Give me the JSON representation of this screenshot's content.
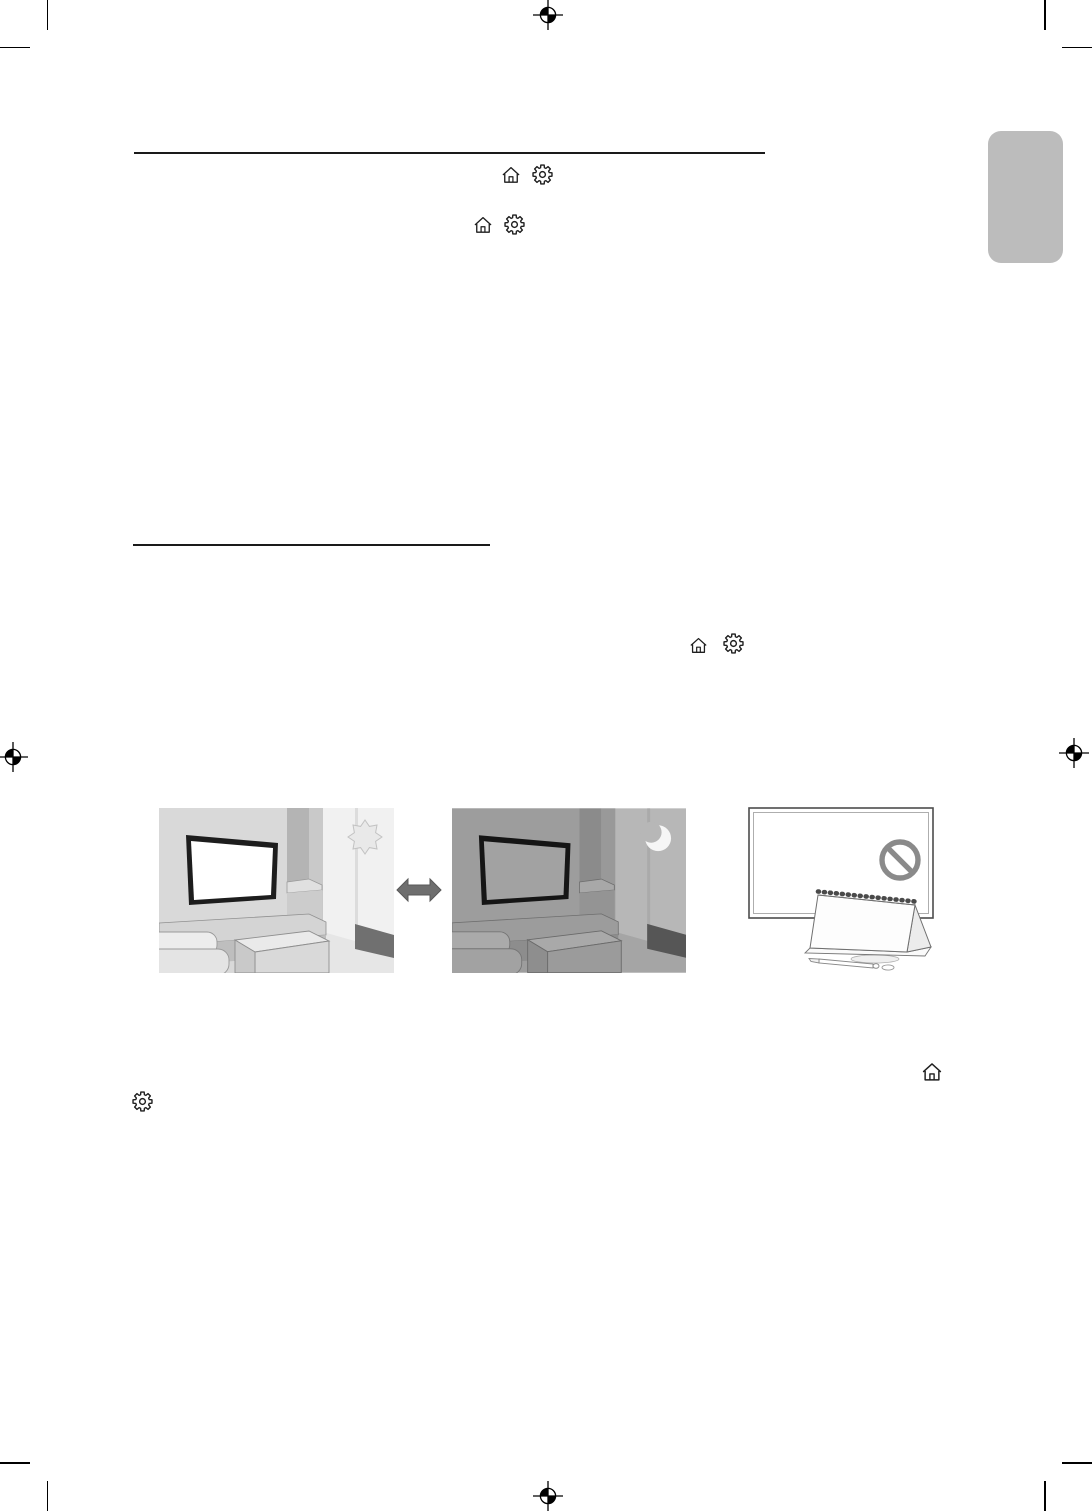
{
  "document": {
    "kind": "printed-manual-page",
    "visible_text": "",
    "note_colors": {
      "page_background": "#ffffff",
      "rule_color": "#1a1a1a",
      "icon_stroke": "#1f1f1f",
      "side_tab": "#bcbcbc",
      "swap_arrow": "#6e6e6e",
      "prohibition_sign": "#8a8a8a"
    }
  },
  "printer_marks": {
    "registration_targets": [
      {
        "id": "registration-top-center"
      },
      {
        "id": "registration-left-middle"
      },
      {
        "id": "registration-right-middle"
      },
      {
        "id": "registration-bottom-center"
      }
    ],
    "crop_corners": [
      "top-left",
      "top-right",
      "bottom-left",
      "bottom-right"
    ]
  },
  "rules": [
    {
      "id": "section-rule-top"
    },
    {
      "id": "section-rule-middle"
    }
  ],
  "icons": {
    "home": "home-icon",
    "settings": "settings-gear-icon"
  },
  "inline_icon_groups": [
    {
      "id": "icon-row-1",
      "icons": [
        "home-icon",
        "settings-gear-icon"
      ]
    },
    {
      "id": "icon-row-2",
      "icons": [
        "home-icon",
        "settings-gear-icon"
      ]
    },
    {
      "id": "icon-row-3",
      "icons": [
        "home-icon",
        "settings-gear-icon"
      ]
    },
    {
      "id": "icon-home-bottom-right",
      "icons": [
        "home-icon"
      ]
    },
    {
      "id": "icon-settings-bottom-left",
      "icons": [
        "settings-gear-icon"
      ]
    }
  ],
  "figures": [
    {
      "id": "figure-day-scene",
      "alt": "living-room-daytime-with-tv-and-sun"
    },
    {
      "id": "figure-swap-arrow",
      "alt": "double-headed-swap-arrow"
    },
    {
      "id": "figure-night-scene",
      "alt": "living-room-nighttime-with-tv-and-moon"
    },
    {
      "id": "figure-no-obstruction",
      "alt": "tv-with-prohibition-sign-and-desk-calendar-in-front"
    }
  ],
  "side_tab": {
    "id": "section-index-tab",
    "label": ""
  }
}
